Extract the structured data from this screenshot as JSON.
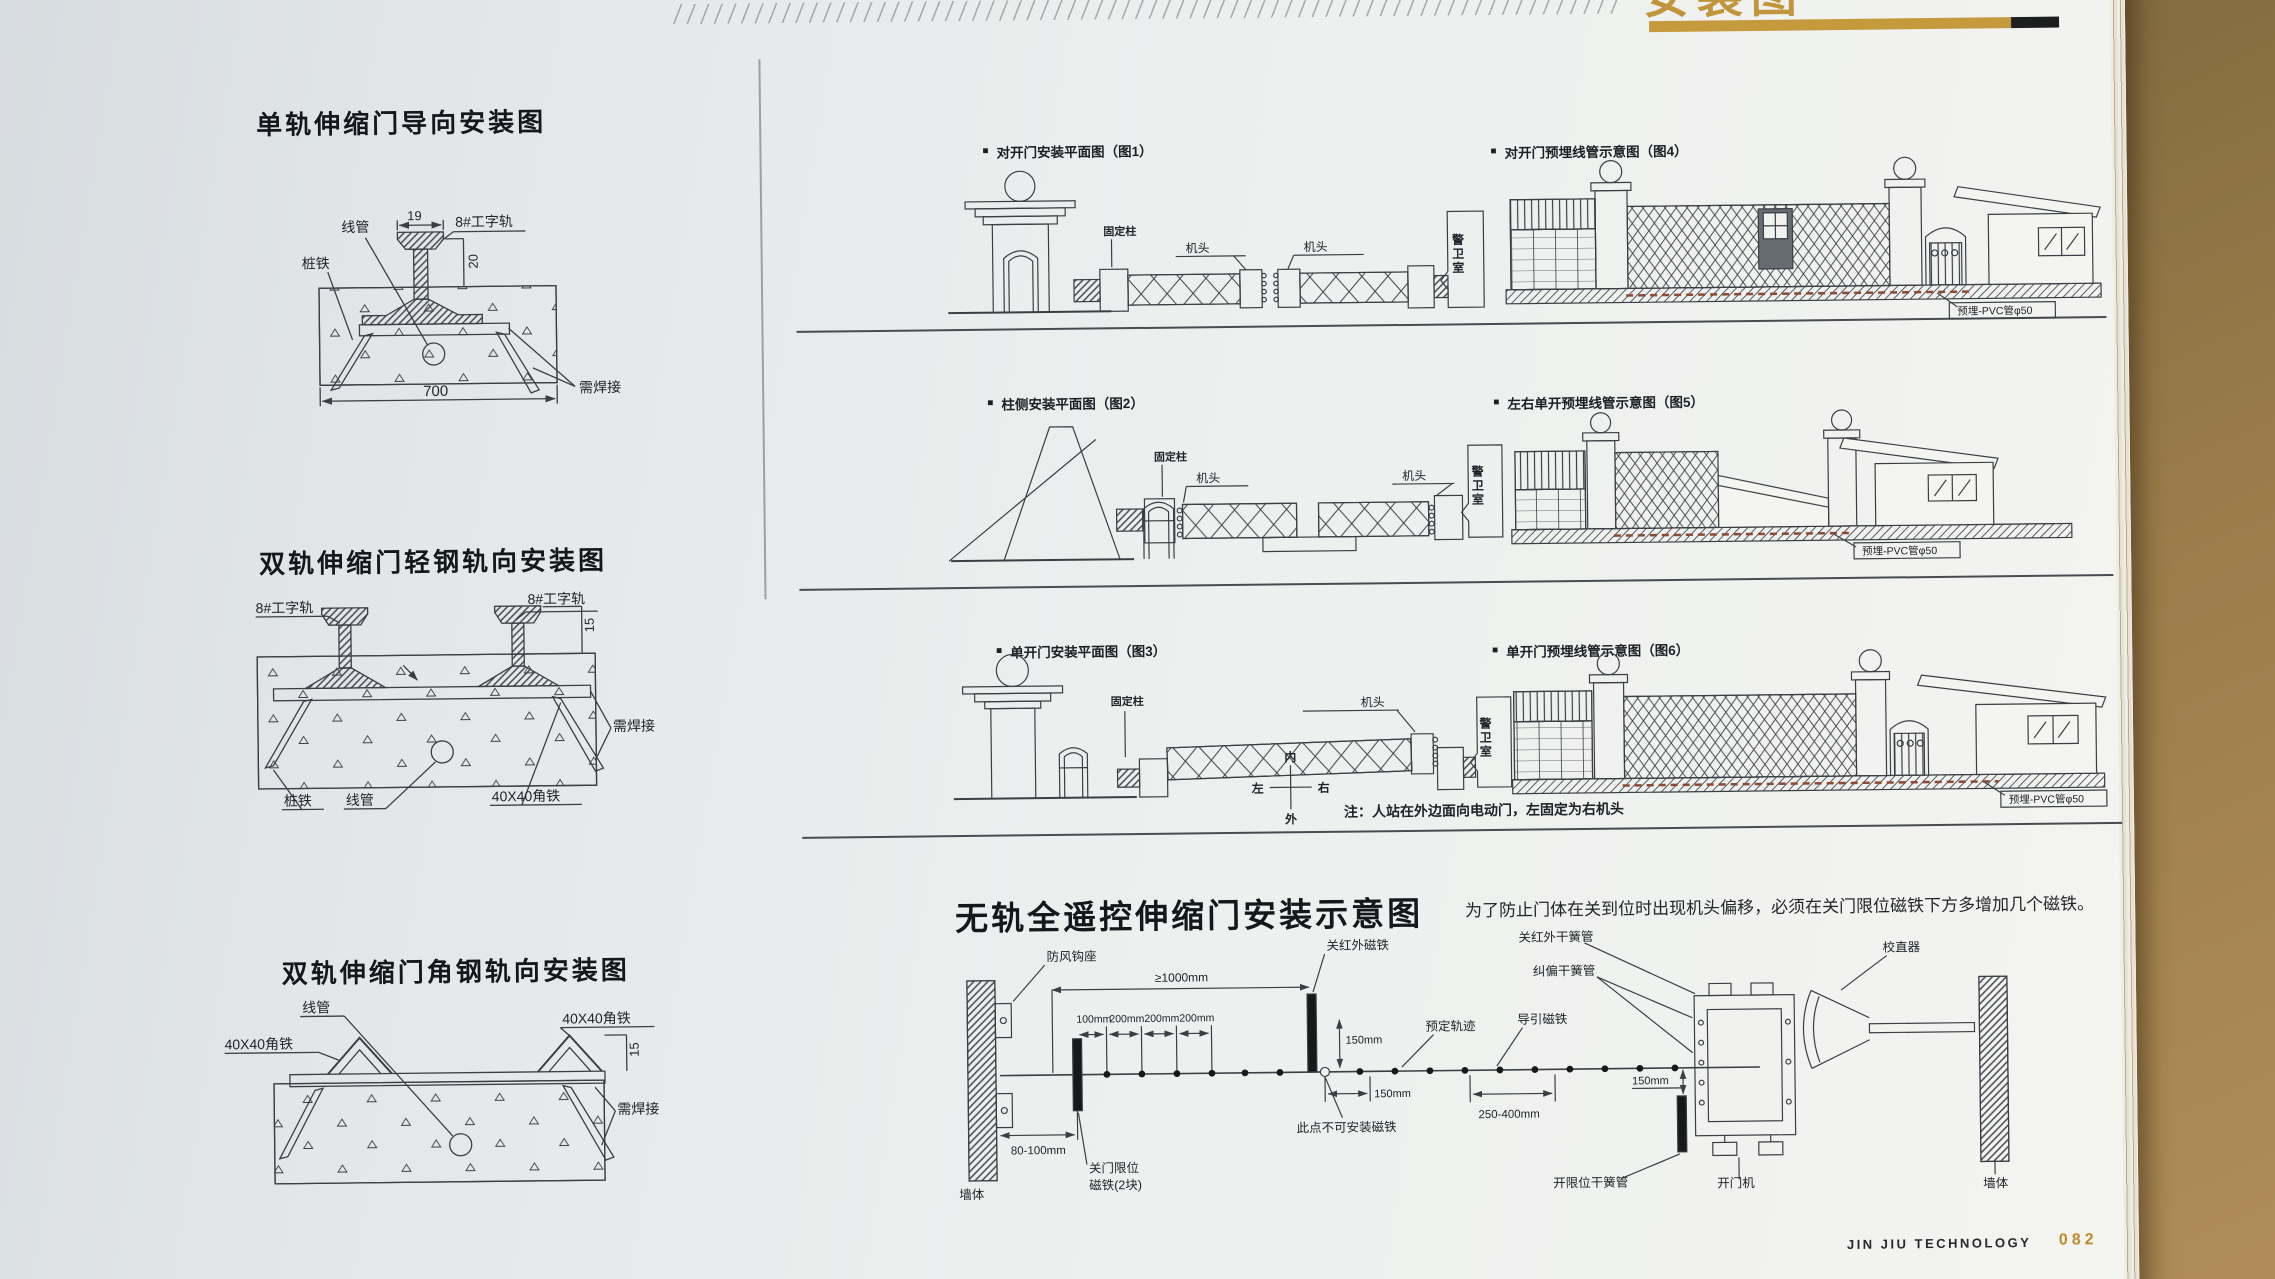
{
  "header": {
    "title_cn": "安装图",
    "title_en": "INSTALLATION DRAWINGS"
  },
  "footer": {
    "brand": "JIN JIU TECHNOLOGY",
    "page_no": "082"
  },
  "left": {
    "d1": {
      "title": "单轨伸缩门导向安装图",
      "conduit": "线管",
      "rail": "8#工字轨",
      "stake": "桩铁",
      "weld": "需焊接",
      "dim_top": "19",
      "dim_h": "20",
      "dim_w": "700"
    },
    "d2": {
      "title": "双轨伸缩门轻钢轨向安装图",
      "rail_l": "8#工字轨",
      "rail_r": "8#工字轨",
      "dim_h": "15",
      "weld": "需焊接",
      "stake": "桩铁",
      "conduit": "线管",
      "angle": "40X40角铁"
    },
    "d3": {
      "title": "双轨伸缩门角钢轨向安装图",
      "conduit": "线管",
      "angle_l": "40X40角铁",
      "angle_r": "40X40角铁",
      "dim_h": "15",
      "weld": "需焊接"
    }
  },
  "figs": {
    "bullet": "■",
    "f1": {
      "title": "对开门安装平面图（图1）",
      "post": "固定柱",
      "head_l": "机头",
      "head_r": "机头",
      "guard": "警卫室"
    },
    "f4": {
      "title": "对开门预埋线管示意图（图4）",
      "pvc": "预埋-PVC管φ50"
    },
    "f2": {
      "title": "柱侧安装平面图（图2）",
      "post": "固定柱",
      "head_l": "机头",
      "head_r": "机头",
      "guard": "警卫室"
    },
    "f5": {
      "title": "左右单开预埋线管示意图（图5）",
      "pvc": "预埋-PVC管φ50"
    },
    "f3": {
      "title": "单开门安装平面图（图3）",
      "post": "固定柱",
      "head": "机头",
      "guard": "警卫室",
      "dir_in": "内",
      "dir_out": "外",
      "dir_left": "左",
      "dir_right": "右",
      "note": "注：人站在外边面向电动门，左固定为右机头"
    },
    "f6": {
      "title": "单开门预埋线管示意图（图6）",
      "pvc": "预埋-PVC管φ50"
    }
  },
  "trackless": {
    "title": "无轨全遥控伸缩门安装示意图",
    "note": "为了防止门体在关到位时出现机头偏移，必须在关门限位磁铁下方多增加几个磁铁。",
    "wind_hook": "防风钩座",
    "close_ir_magnet": "关红外磁铁",
    "close_ir_reed": "关红外干簧管",
    "align_reed": "纠偏干簧管",
    "straightener": "校直器",
    "dim_1000": "≥1000mm",
    "dim_100": "100mm",
    "dim_200_1": "200mm",
    "dim_200_2": "200mm",
    "dim_200_3": "200mm",
    "dim_150_a": "150mm",
    "track": "预定轨迹",
    "guide_magnet": "导引磁铁",
    "no_magnet_note": "此点不可安装磁铁",
    "dim_150_b": "150mm",
    "dim_250_400": "250-400mm",
    "dim_150_c": "150mm",
    "dim_80_100": "80-100mm",
    "close_limit_line1": "关门限位",
    "close_limit_line2": "磁铁(2块)",
    "open_limit_reed": "开限位干簧管",
    "opener": "开门机",
    "wall_left": "墙体",
    "wall_right": "墙体"
  }
}
